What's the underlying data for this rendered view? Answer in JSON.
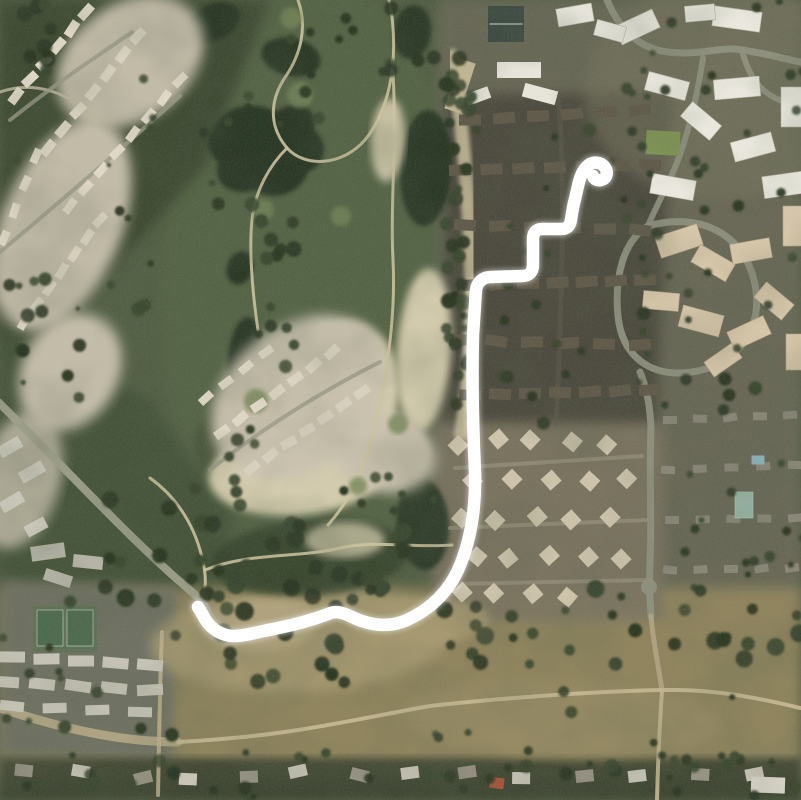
{
  "description": "Satellite aerial photograph of a golf course bordered by residential neighborhoods, apartment complexes and a dry grassland field, with a thick white GPS route line overlaid. The route starts with a small hook in the condominium area at the upper right, descends in a stair-step pattern, runs straight down along the golf course edge, then sweeps left along the bottom of the course and ends above a tennis-court condo complex at the lower left.",
  "route": {
    "color": "#ffffff",
    "width": 12.5,
    "path": "M 198 607 C 200 610 202 613 205 619 C 211 629 222 636 234 636 C 243 636 255 633 268 630 C 290 626 312 620 328 614 C 336 610 344 613 352 617 C 371 626 389 628 407 620 C 433 608 451 589 461 563 C 471 537 476 507 475 472 C 473 430 472 375 473 335 L 476 290 C 477 282 483 277 491 277 L 522 276 C 529 276 533 272 533 265 L 533 239 C 533 233 536 229 542 229 L 561 229 C 567 229 570 226 571 220 C 572 213 573 206 575 199 L 578 186 C 580 176 584 168 590 164 C 596 161 603 163 606 169 C 608 174 606 179 601 180 C 597 181 594 179 593 176"
  },
  "palette": {
    "base_green": "#535F45",
    "dark_slope": "#3E4A33",
    "mid_slope": "#45523A",
    "golf_band": "#566546",
    "pond": "#2C3927",
    "sand": "#DBD2B4",
    "housing_pale": "#CBC3B0",
    "field": "#93865F",
    "field_light": "#A89B73",
    "road": "#8F9180",
    "trail": "#CEC4A0",
    "dirt_road": "#B1A584",
    "condo_dark": "#4C4A3E",
    "roof_dark": "#615A4B",
    "house_beige": "#CFC5AD",
    "building_white": "#ECEAE0",
    "building_tan": "#D8C7AA",
    "residential_base": "#6C6A5A",
    "tree_dark": "#2C3824",
    "tree_mid": "#3A4830",
    "green_turf": "#76875A",
    "route_white": "#FFFFFF"
  }
}
